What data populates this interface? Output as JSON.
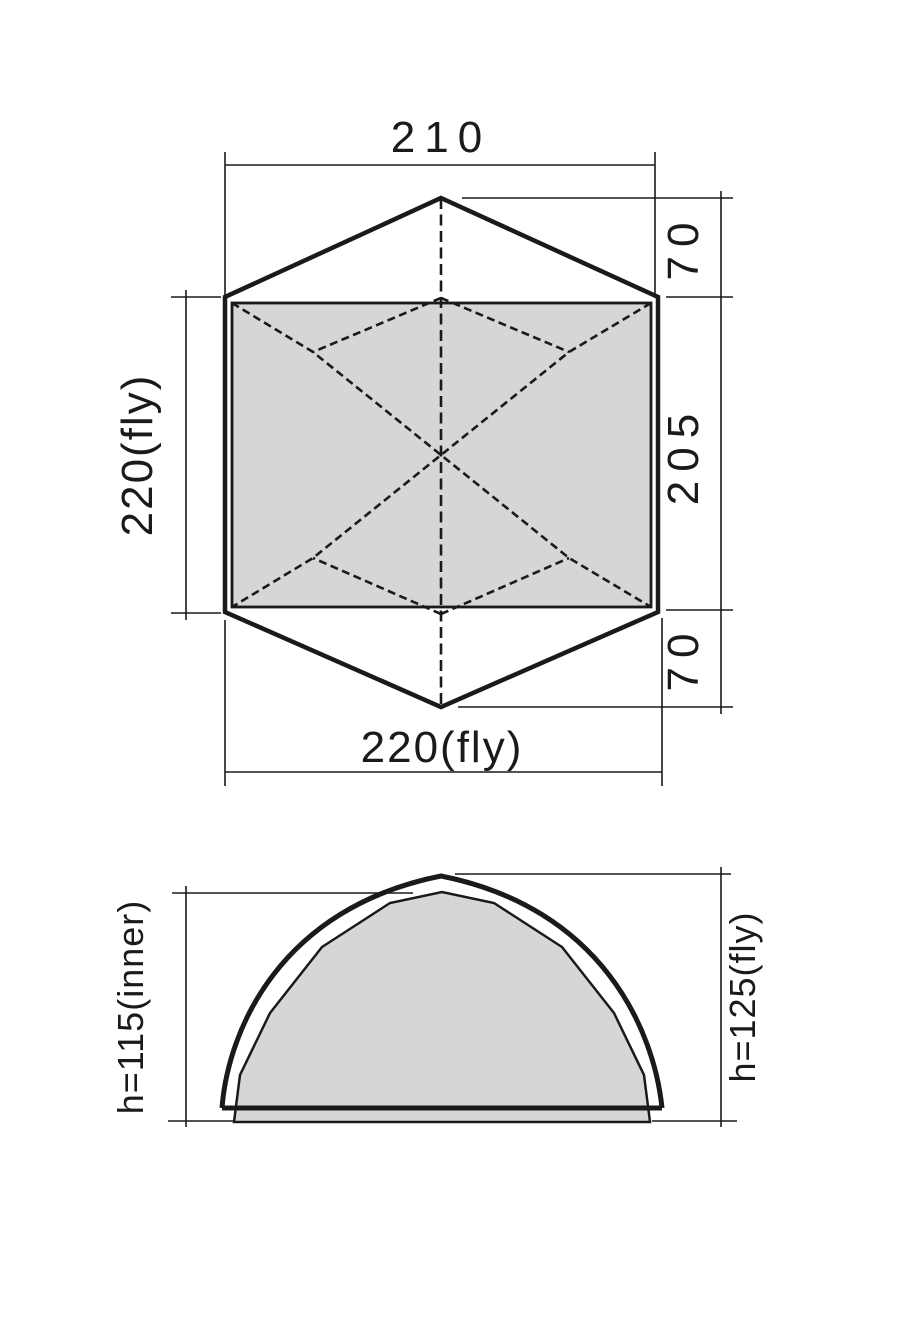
{
  "diagram_title": "tent-dimension-drawing",
  "top_view": {
    "dim_top_width": "210",
    "dim_left_fly_length": "220(fly)",
    "dim_bottom_fly_width": "220(fly)",
    "dim_right_vestibule_top": "70",
    "dim_right_inner_length": "205",
    "dim_right_vestibule_bottom": "70"
  },
  "side_view": {
    "dim_inner_height": "h=115(inner)",
    "dim_fly_height": "h=125(fly)"
  },
  "measurements": {
    "inner_width_cm": 210,
    "fly_width_cm": 220,
    "inner_length_cm": 205,
    "vestibule_depth_cm": 70,
    "inner_height_cm": 115,
    "fly_height_cm": 125
  },
  "colors": {
    "line": "#1a1a1a",
    "inner_fill": "#d6d6d6",
    "background": "#ffffff"
  }
}
